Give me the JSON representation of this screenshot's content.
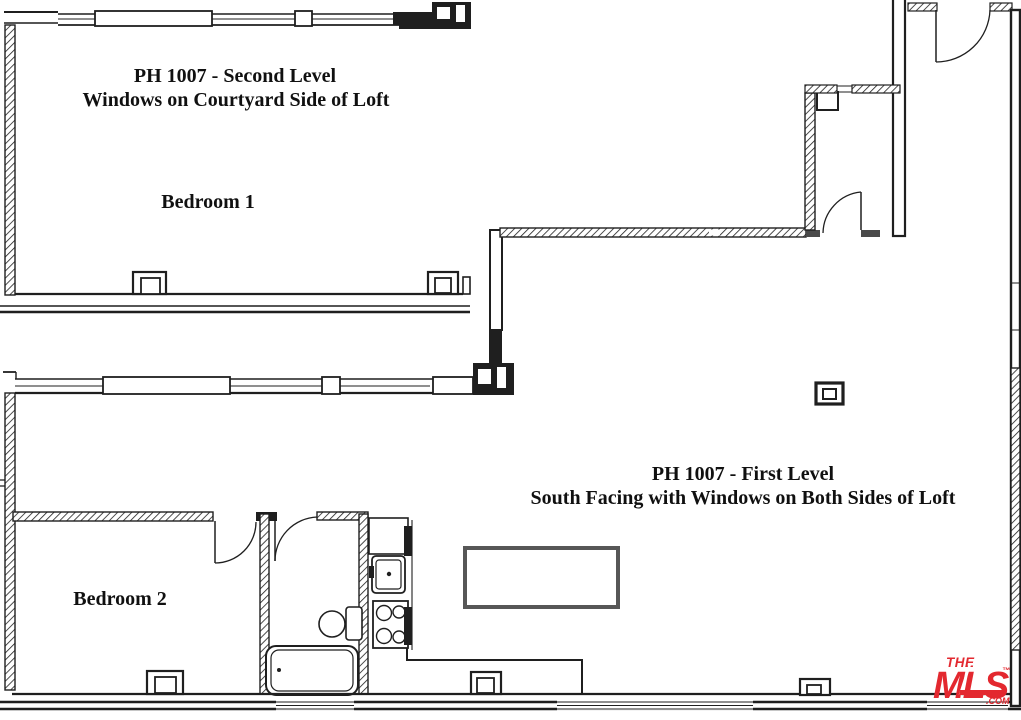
{
  "brand": {
    "red": "#e3282f"
  },
  "drawing": {
    "ink": "#1f1f1f",
    "island_gray": "#575757",
    "threshold_gray": "#4a4a4a",
    "background": "#ffffff"
  },
  "levels": {
    "second": {
      "title": "PH 1007 - Second Level",
      "subtitle": "Windows on Courtyard Side of Loft",
      "room_label": "Bedroom 1"
    },
    "first": {
      "title": "PH 1007 - First Level",
      "subtitle": "South Facing with Windows on Both Sides of Loft",
      "room_label": "Bedroom 2"
    }
  },
  "logo": {
    "line1": "THE",
    "line2": "MLS",
    "trademark": "™",
    "suffix": ".COM"
  },
  "fixtures": [
    "bathtub",
    "toilet",
    "kitchen-sink",
    "stove",
    "refrigerator",
    "kitchen-island",
    "structural-columns",
    "door-swings",
    "window-walls"
  ]
}
